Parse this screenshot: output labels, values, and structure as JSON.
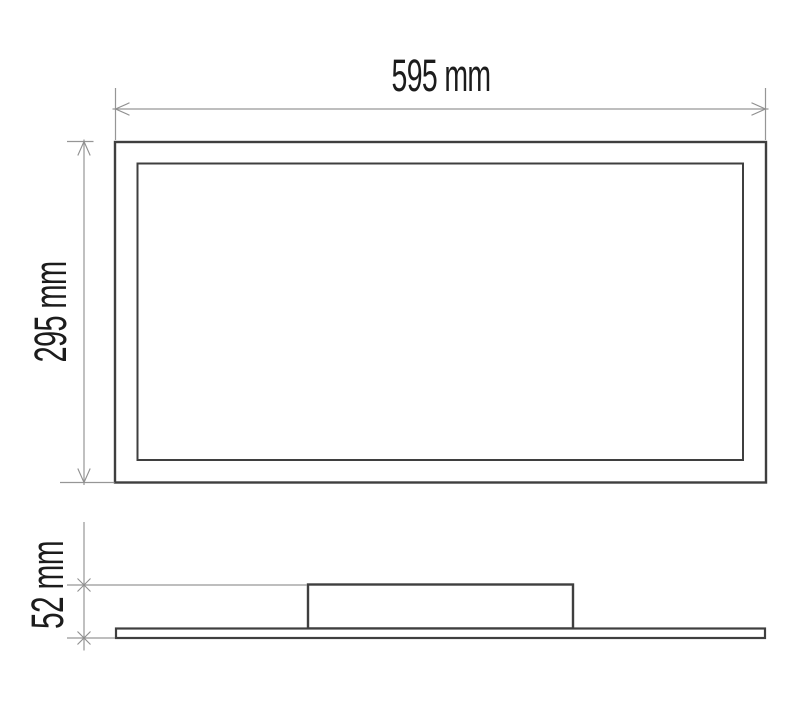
{
  "drawing": {
    "type": "technical-dimension-drawing",
    "top_view": {
      "width_dimension_label": "595 mm",
      "height_dimension_label": "295 mm"
    },
    "side_view": {
      "thickness_dimension_label": "52 mm"
    },
    "values": {
      "width_mm": 595,
      "height_mm": 295,
      "thickness_mm": 52
    },
    "colors": {
      "outline": "#3f3f3f",
      "dimension_lines": "#969696",
      "label_text": "#1c1c1c",
      "background": "#ffffff"
    }
  }
}
